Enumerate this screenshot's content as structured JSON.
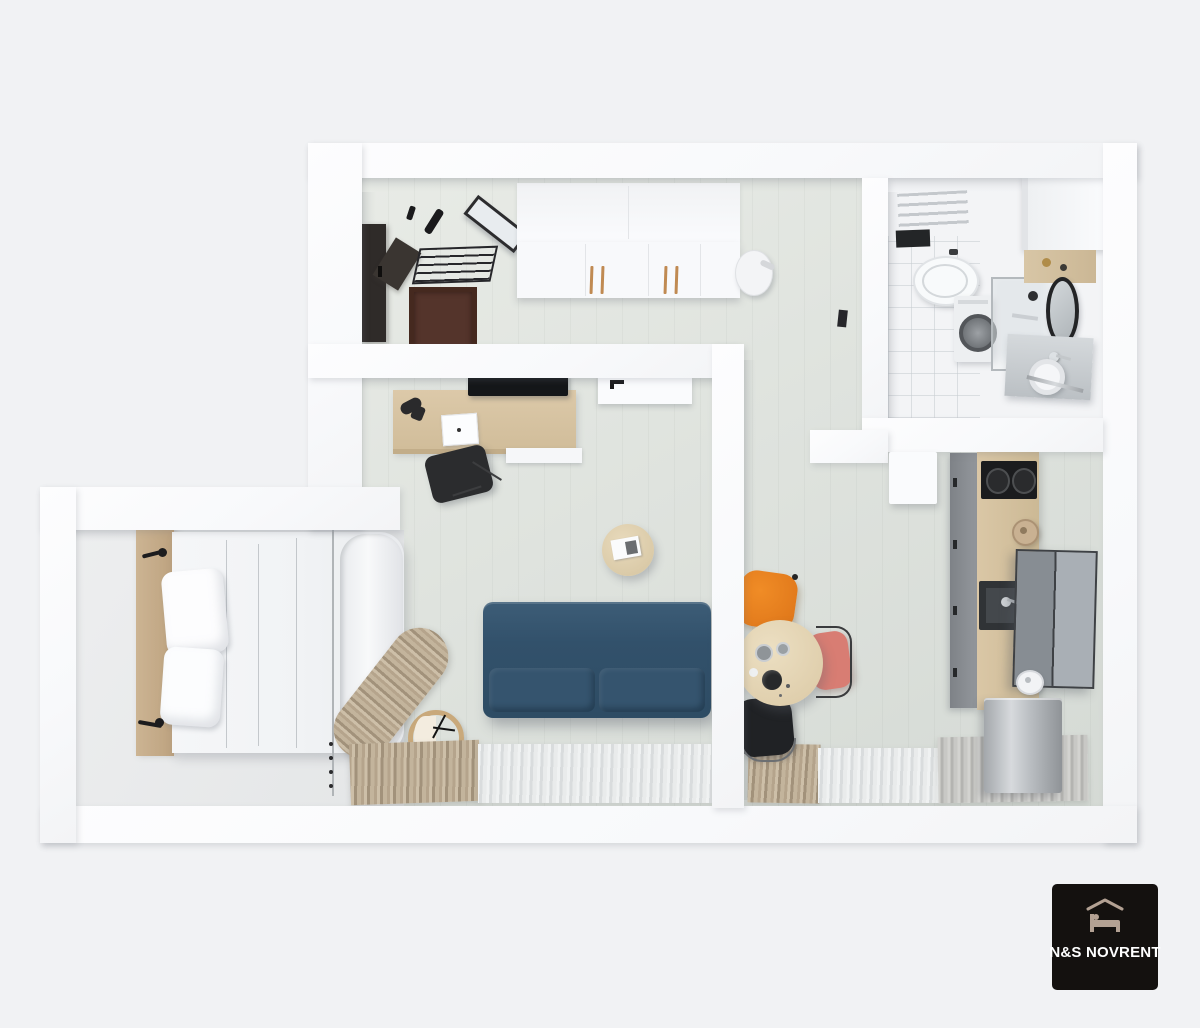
{
  "logo": {
    "brand_text": "N&S NOVRENT",
    "icon": "bed-under-roof-icon",
    "background": "#14110f",
    "text_color": "#ffffff",
    "icon_color": "#b3a193"
  },
  "scene": {
    "type": "3d-floor-plan-top-down-render",
    "rooms": [
      {
        "name": "entry-hall",
        "furniture": [
          "entry-door",
          "coat-hooks",
          "shoe-rack",
          "wall-mirror",
          "doormat",
          "white-wardrobe",
          "portable-vacuum"
        ]
      },
      {
        "name": "bathroom",
        "furniture": [
          "towel-radiator",
          "wall-shelf",
          "toilet",
          "washing-machine",
          "shower-enclosure",
          "tall-cabinet",
          "wood-shelf",
          "round-mirror",
          "sink-counter",
          "faucet",
          "towel-bar",
          "toilet-paper-roll",
          "door-leaf"
        ]
      },
      {
        "name": "living-room",
        "furniture": [
          "wall-tv",
          "desk",
          "desk-lamp",
          "laptop",
          "drawer-unit",
          "office-chair",
          "coffee-table",
          "magazine",
          "sofa-bed",
          "floor-clock",
          "interior-door",
          "window-curtains"
        ]
      },
      {
        "name": "kitchen-dining",
        "furniture": [
          "dining-table",
          "orange-chair",
          "pink-chair",
          "black-chair",
          "base-cabinets",
          "wood-countertop",
          "cooktop",
          "kitchen-sink",
          "wall-cabinets",
          "kettle",
          "white-kettle",
          "fridge",
          "window-curtains"
        ]
      },
      {
        "name": "sleeping-alcove",
        "furniture": [
          "headboard",
          "double-bed",
          "duvet",
          "pillow",
          "pillow",
          "wall-sconce",
          "wall-sconce",
          "curtain-track",
          "privacy-curtain"
        ]
      }
    ],
    "palette": {
      "background": "#f1f2f4",
      "walls": "#fbfcfd",
      "floor_sage": "#dfe3de",
      "bathroom_floor": "#f3f4f6",
      "bedroom_floor": "#e9eaec",
      "sofa_blue": "#32516b",
      "wood_light": "#d8c5a4",
      "curtain_beige": "#b5a48c",
      "curtain_white": "#e9ebeb",
      "chair_orange": "#e07b1e",
      "chair_pink": "#d87d73",
      "chair_black": "#202225",
      "stainless": "#b9bdc1",
      "door_dark": "#2f2b29",
      "mat_brown": "#54342b"
    }
  }
}
